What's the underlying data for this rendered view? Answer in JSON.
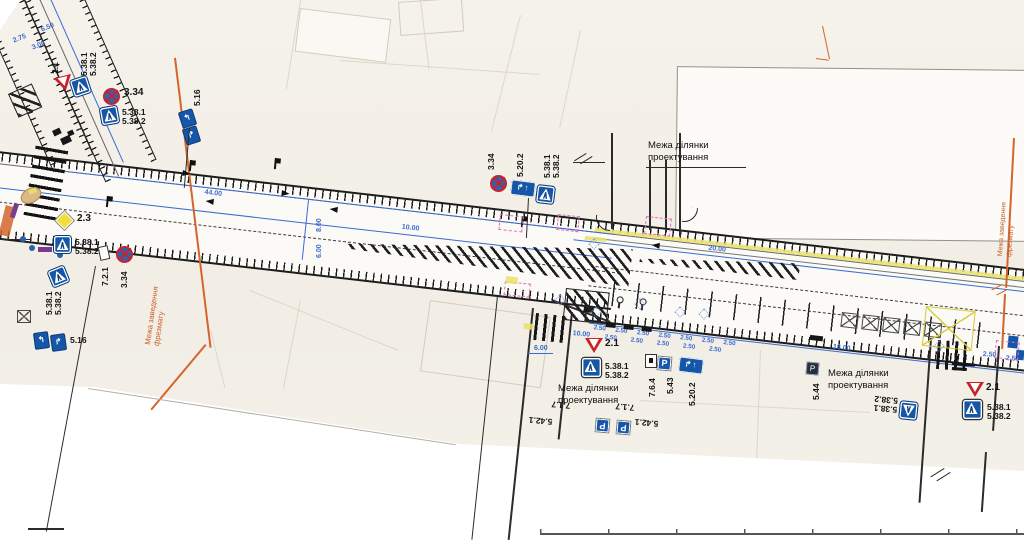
{
  "drawing": {
    "streets": {
      "watermark": "Академіка Сахарова",
      "main_left": "вул. Української перемоги",
      "main_right": "Вул. Української Перемоги"
    },
    "boundary": {
      "line1": "Межа ділянки",
      "line2": "проектування"
    },
    "milling": {
      "line1": "Межа заведення",
      "line2": "фрезмату"
    },
    "signs": {
      "ped1": "5.38.1",
      "ped2": "5.38.2",
      "yield": "2.1",
      "priority": "2.3",
      "no_stop": "3.34",
      "lanes": "5.16",
      "lane_cfg": "5.20.2",
      "parking": "5.43",
      "parking_end": "5.44",
      "parking_kind": "5.42.1",
      "plate_717": "7.1.7",
      "plate_721": "7.2.1",
      "plate_764": "7.6.4",
      "p_glyph": "P"
    },
    "icons": {
      "lanes_a": "↰",
      "lanes_b": "↱",
      "arrow_up": "↑",
      "cfg": "↱↑"
    },
    "dims": {
      "d4400": "44.00",
      "d1000": "10.00",
      "d2000": "20.00",
      "d1800": "18.00",
      "d600": "6.00",
      "d250": "2.50",
      "d650": "6.50",
      "d275": "2.75",
      "d300": "3.00",
      "d800": "8.00"
    },
    "colors": {
      "sign_blue": "#1556a8",
      "dim_blue": "#3a6bd0",
      "milling_orange": "#d4642b",
      "danger_red": "#c8232a",
      "priority_yellow": "#f2dd3c"
    }
  }
}
